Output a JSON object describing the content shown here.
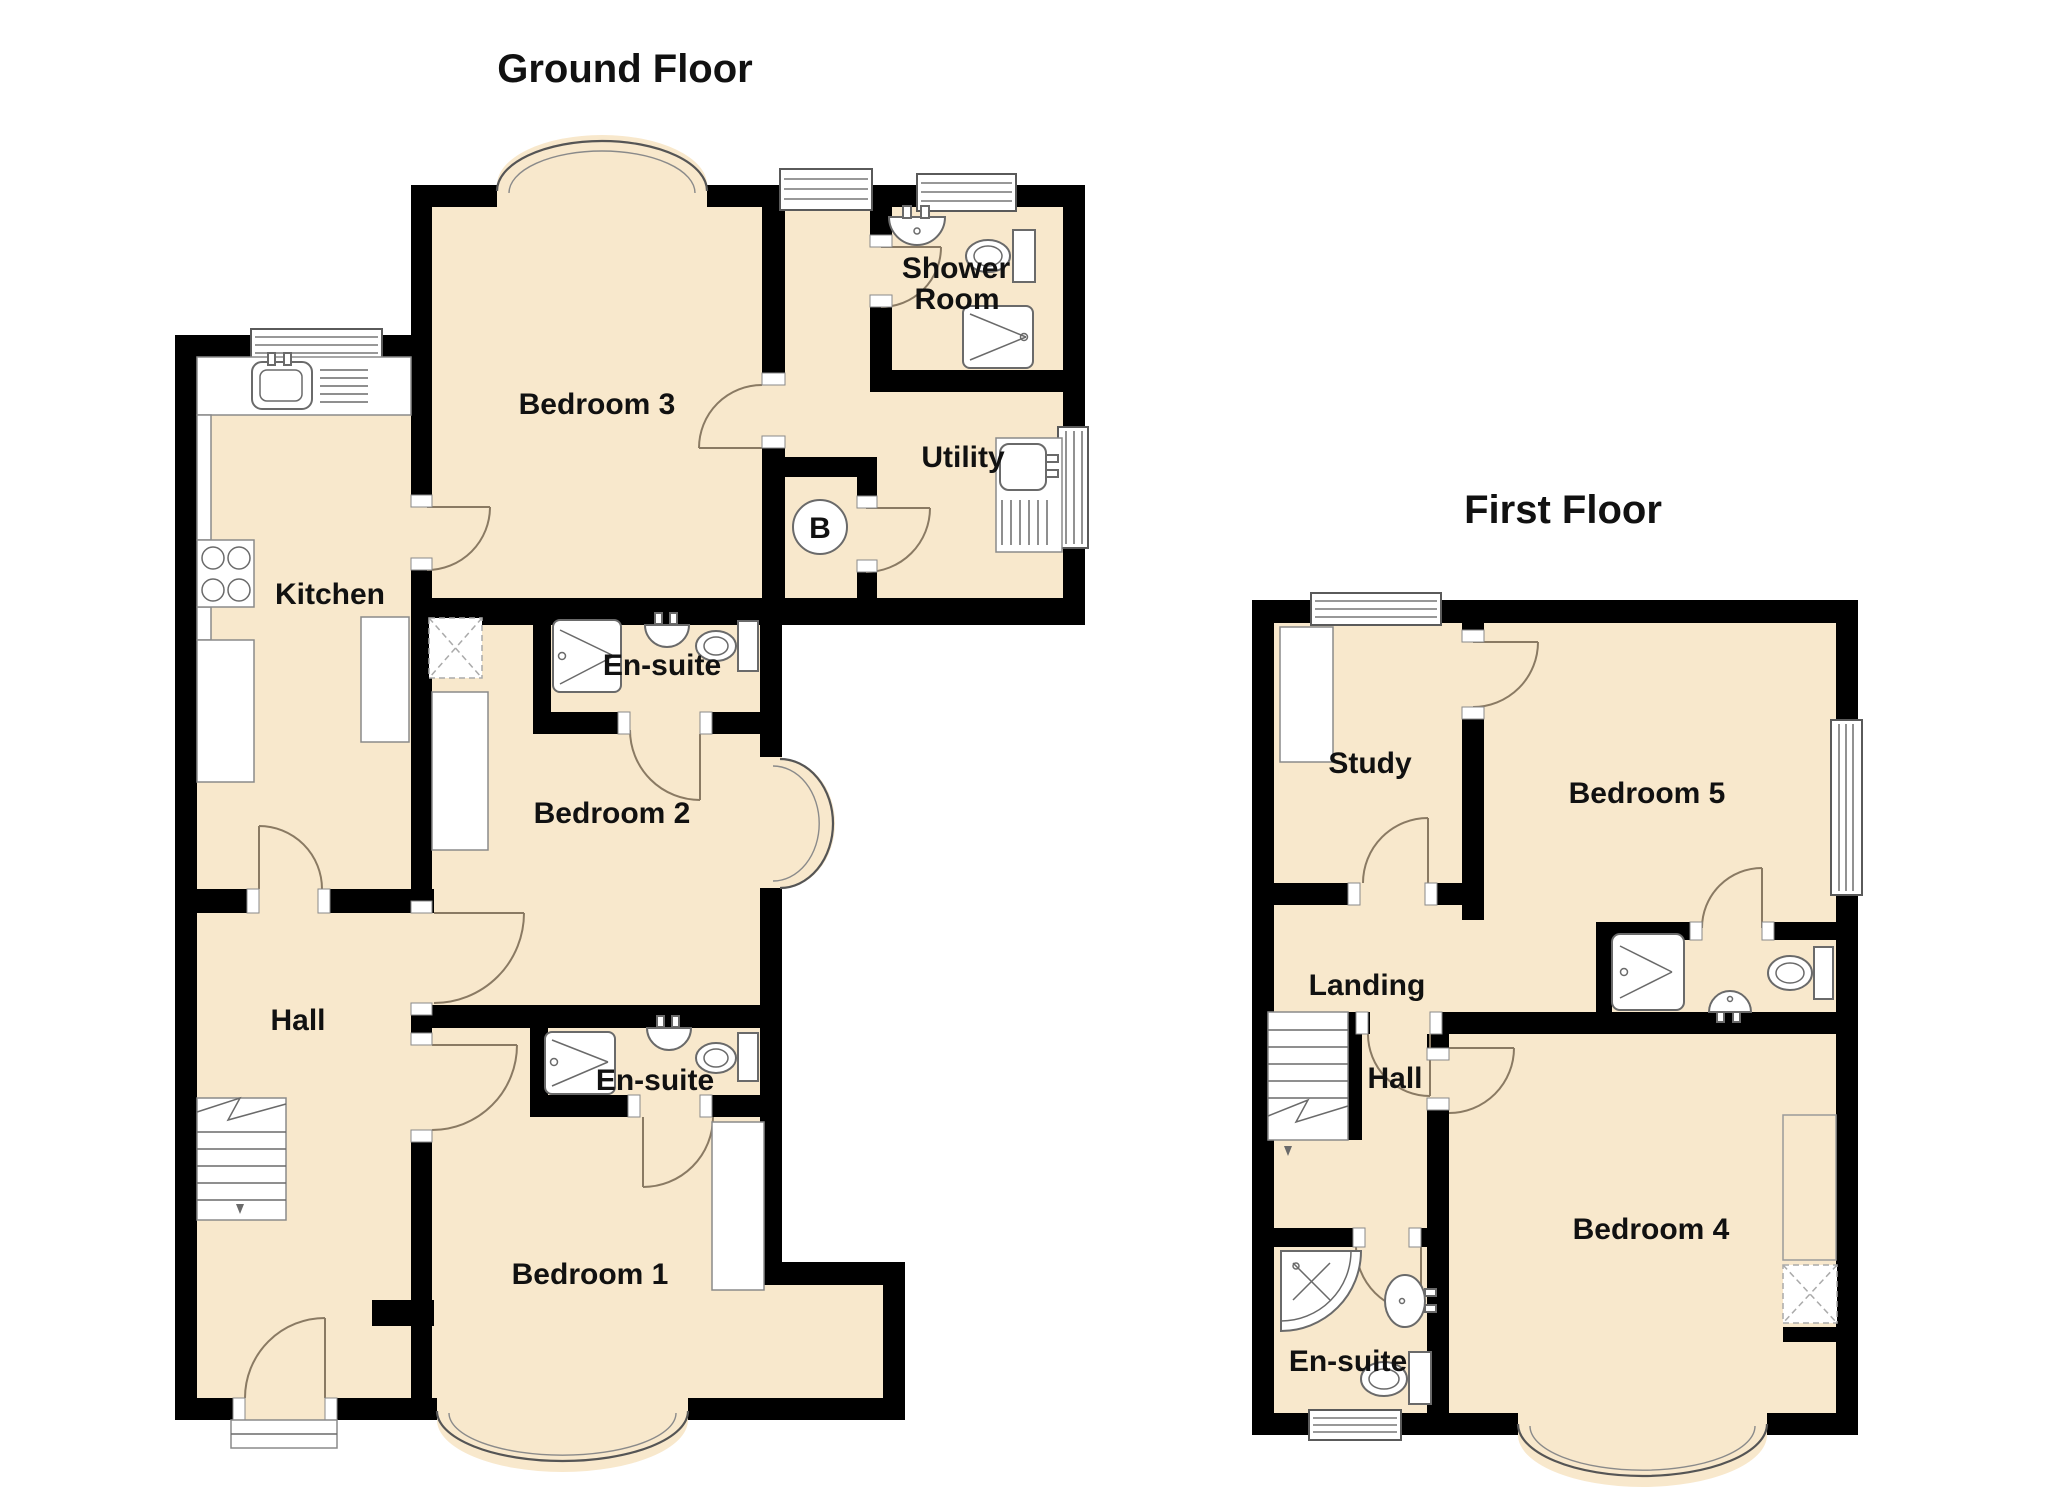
{
  "colors": {
    "floor_fill": "#f8e8cc",
    "wall": "#000000",
    "door_swing": "#8a7a63",
    "fixture_outline": "#6a6a6a",
    "text": "#111111"
  },
  "floors": [
    {
      "title": "Ground Floor",
      "boiler": "B",
      "rooms": [
        {
          "label": "Bedroom 3"
        },
        {
          "label": "Shower Room",
          "line1": "Shower",
          "line2": "Room"
        },
        {
          "label": "Utility"
        },
        {
          "label": "Kitchen"
        },
        {
          "label": "En-suite"
        },
        {
          "label": "Bedroom 2"
        },
        {
          "label": "Hall"
        },
        {
          "label": "En-suite"
        },
        {
          "label": "Bedroom 1"
        }
      ]
    },
    {
      "title": "First Floor",
      "rooms": [
        {
          "label": "Study"
        },
        {
          "label": "Bedroom 5"
        },
        {
          "label": "Landing"
        },
        {
          "label": "Hall"
        },
        {
          "label": "En-suite"
        },
        {
          "label": "Bedroom 4"
        }
      ]
    }
  ]
}
